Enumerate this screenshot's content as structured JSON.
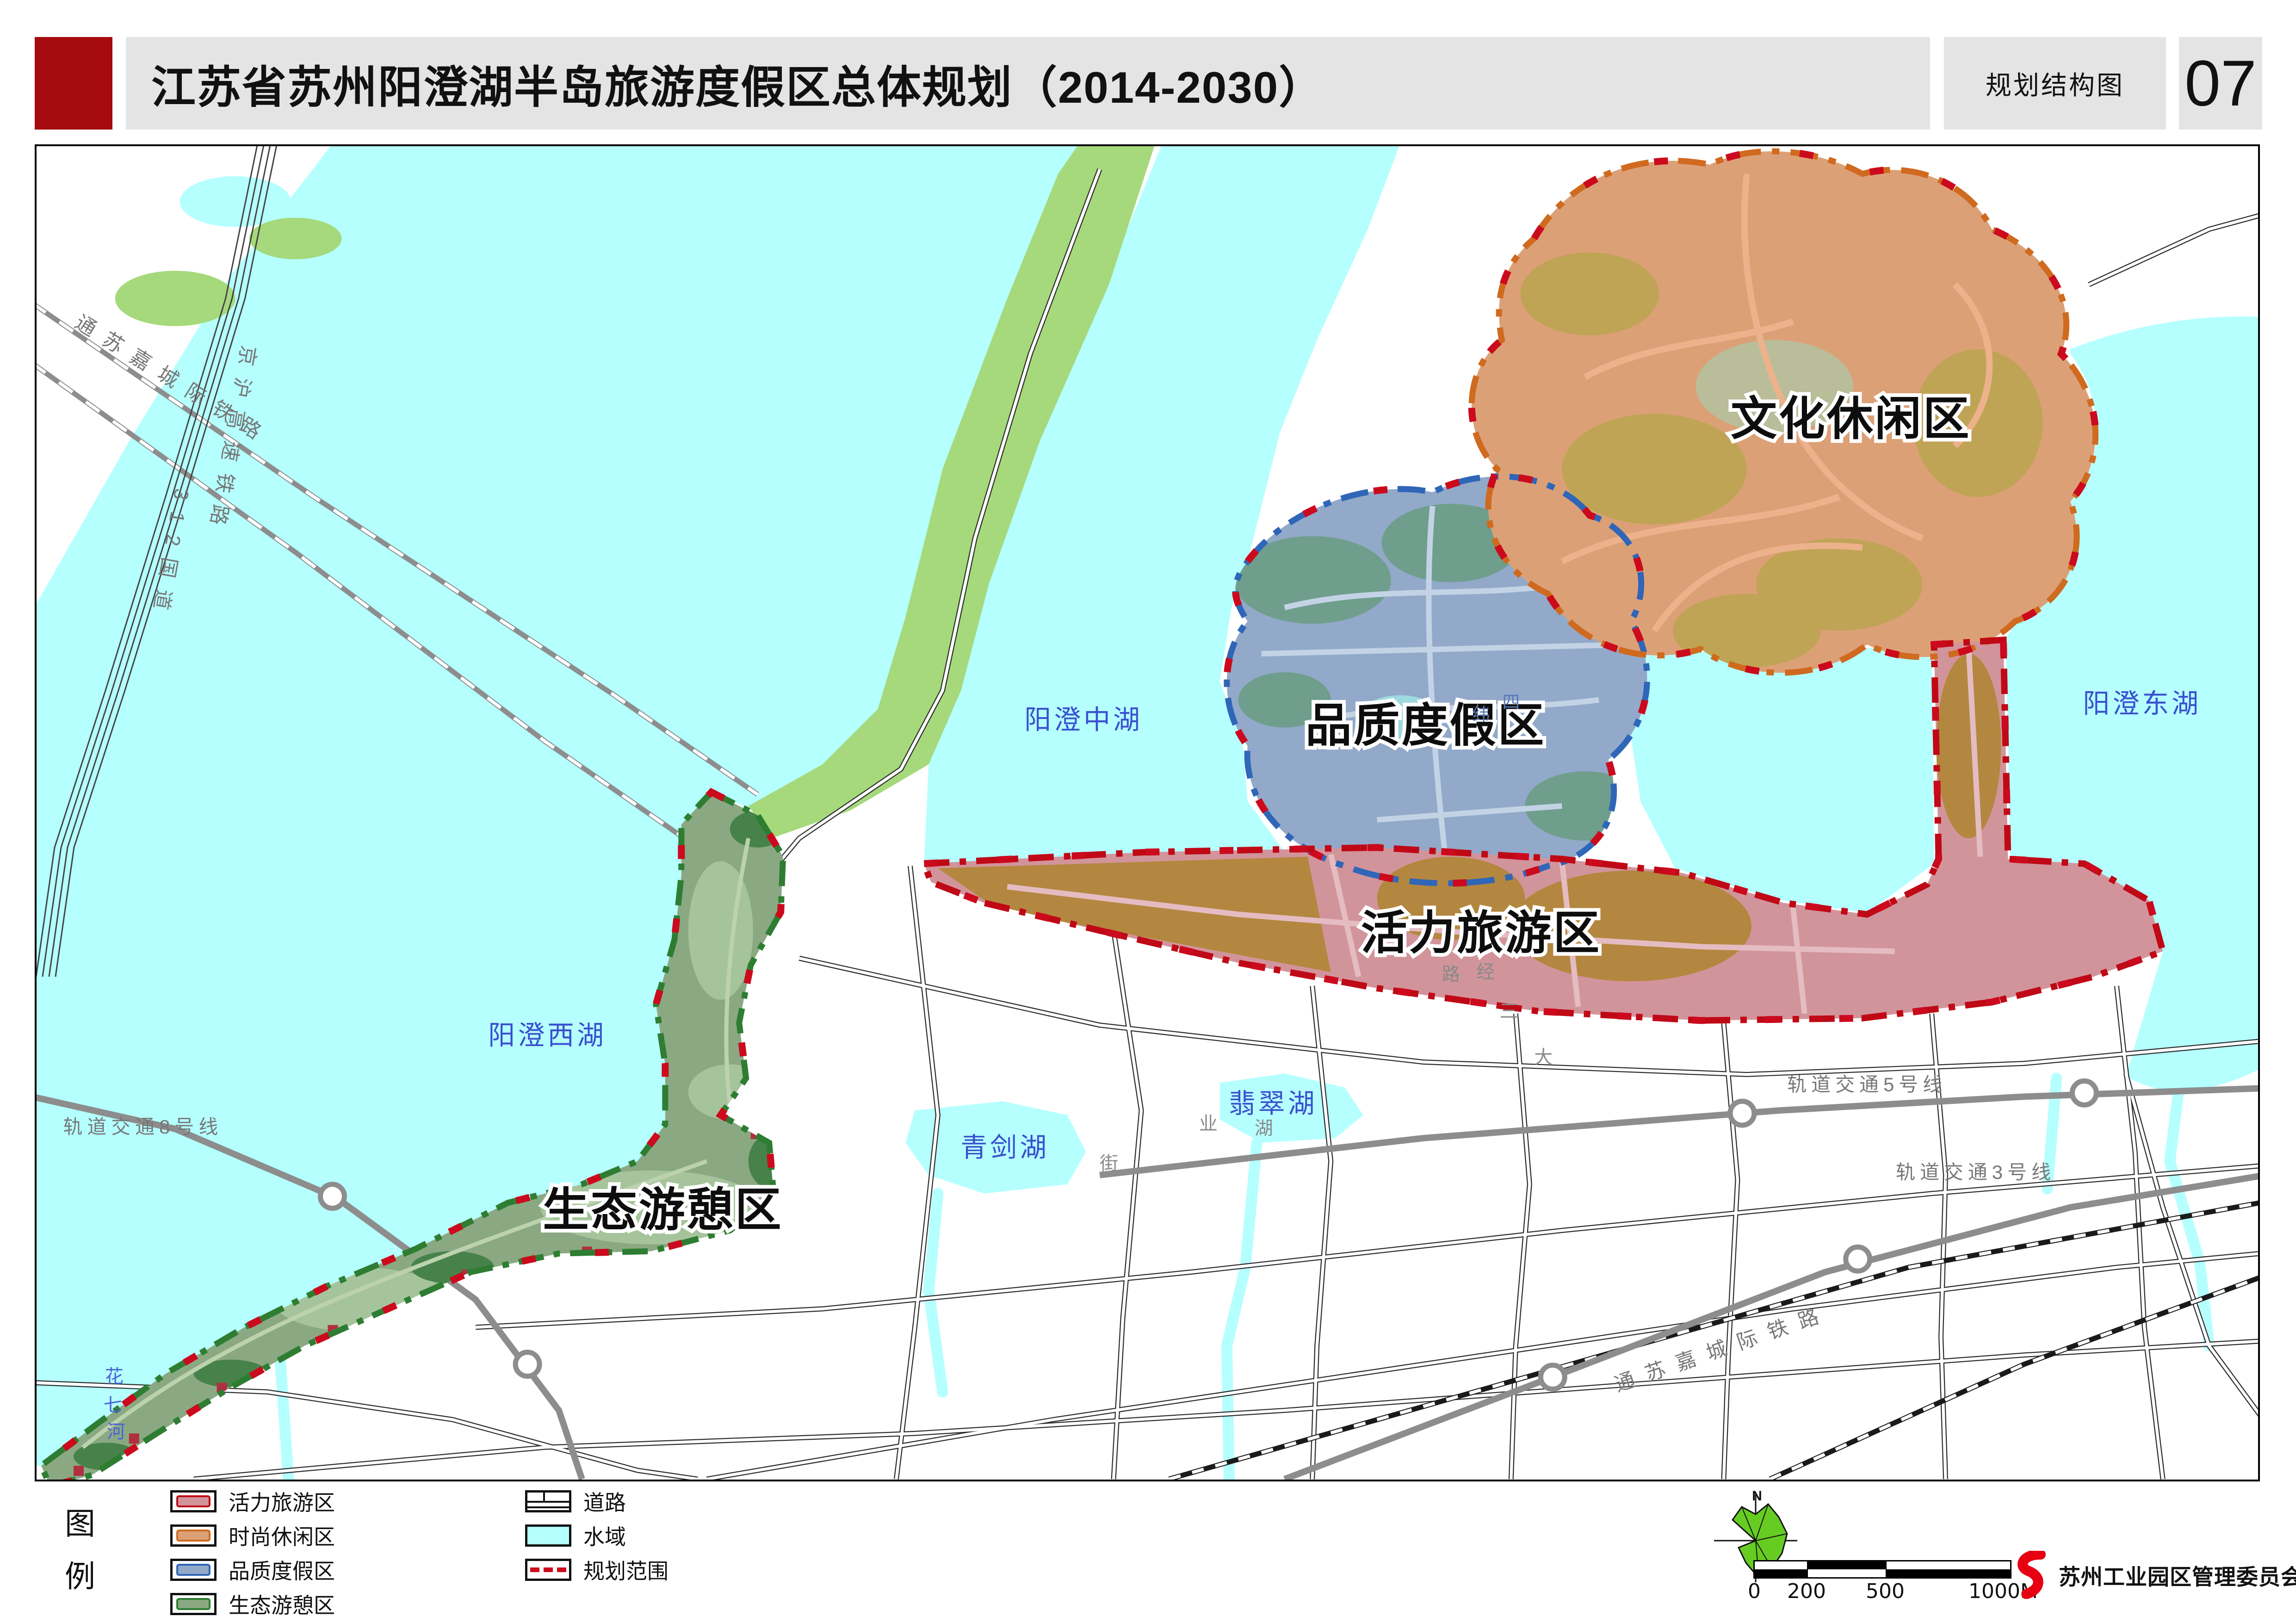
{
  "header": {
    "title": "江苏省苏州阳澄湖半岛旅游度假区总体规划（2014-2030）",
    "map_type_label": "规划结构图",
    "page_number": "07"
  },
  "colors": {
    "header_accent": "#A50B0E",
    "header_bar": "#E4E4E4",
    "water": "#B5FFFF",
    "wetland": "#A5D97B",
    "plan_boundary": "#CC0A1D",
    "vitality_fill": "#D2949B",
    "vitality_border": "#C00916",
    "leisure_fill": "#DCA077",
    "leisure_border": "#CF6A1F",
    "quality_fill": "#92A9C9",
    "quality_border": "#2F66B8",
    "eco_fill": "#8AA983",
    "eco_border": "#2E7D32",
    "logo_red": "#E60012"
  },
  "legend": {
    "title_chars": [
      "图",
      "例"
    ],
    "zones": [
      {
        "label": "活力旅游区",
        "fill": "#D2949B",
        "border": "#C00916"
      },
      {
        "label": "时尚休闲区",
        "fill": "#DCA077",
        "border": "#CF6A1F"
      },
      {
        "label": "品质度假区",
        "fill": "#92A9C9",
        "border": "#2F66B8"
      },
      {
        "label": "生态游憩区",
        "fill": "#8AA983",
        "border": "#2E7D32"
      }
    ],
    "features": [
      {
        "label": "道路",
        "type": "road"
      },
      {
        "label": "水域",
        "type": "water"
      },
      {
        "label": "规划范围",
        "type": "boundary"
      }
    ]
  },
  "map": {
    "region_labels": [
      "文化休闲区",
      "品质度假区",
      "活力旅游区",
      "生态游憩区"
    ],
    "water_labels": [
      "阳澄中湖",
      "阳澄西湖",
      "阳澄东湖",
      "翡翠湖",
      "青剑湖"
    ],
    "river_chars": [
      "花",
      "七",
      "河"
    ],
    "transit_labels": [
      "轨道交通8号线",
      "轨道交通5号线",
      "轨道交通3号线"
    ],
    "railway_labels": {
      "top_left": "通苏嘉城际铁路",
      "hsr": "京沪高速铁路",
      "national_road": "312国道",
      "bottom_right": "通苏嘉城际铁路"
    },
    "road_fragments": [
      "纬",
      "四",
      "路",
      "经",
      "三",
      "大",
      "湖",
      "业",
      "街"
    ]
  },
  "north_arrow": {
    "label": "N"
  },
  "scale_bar": {
    "ticks": [
      "0",
      "200",
      "500",
      "1000M"
    ]
  },
  "footer": {
    "organization": "苏州工业园区管理委员会"
  }
}
